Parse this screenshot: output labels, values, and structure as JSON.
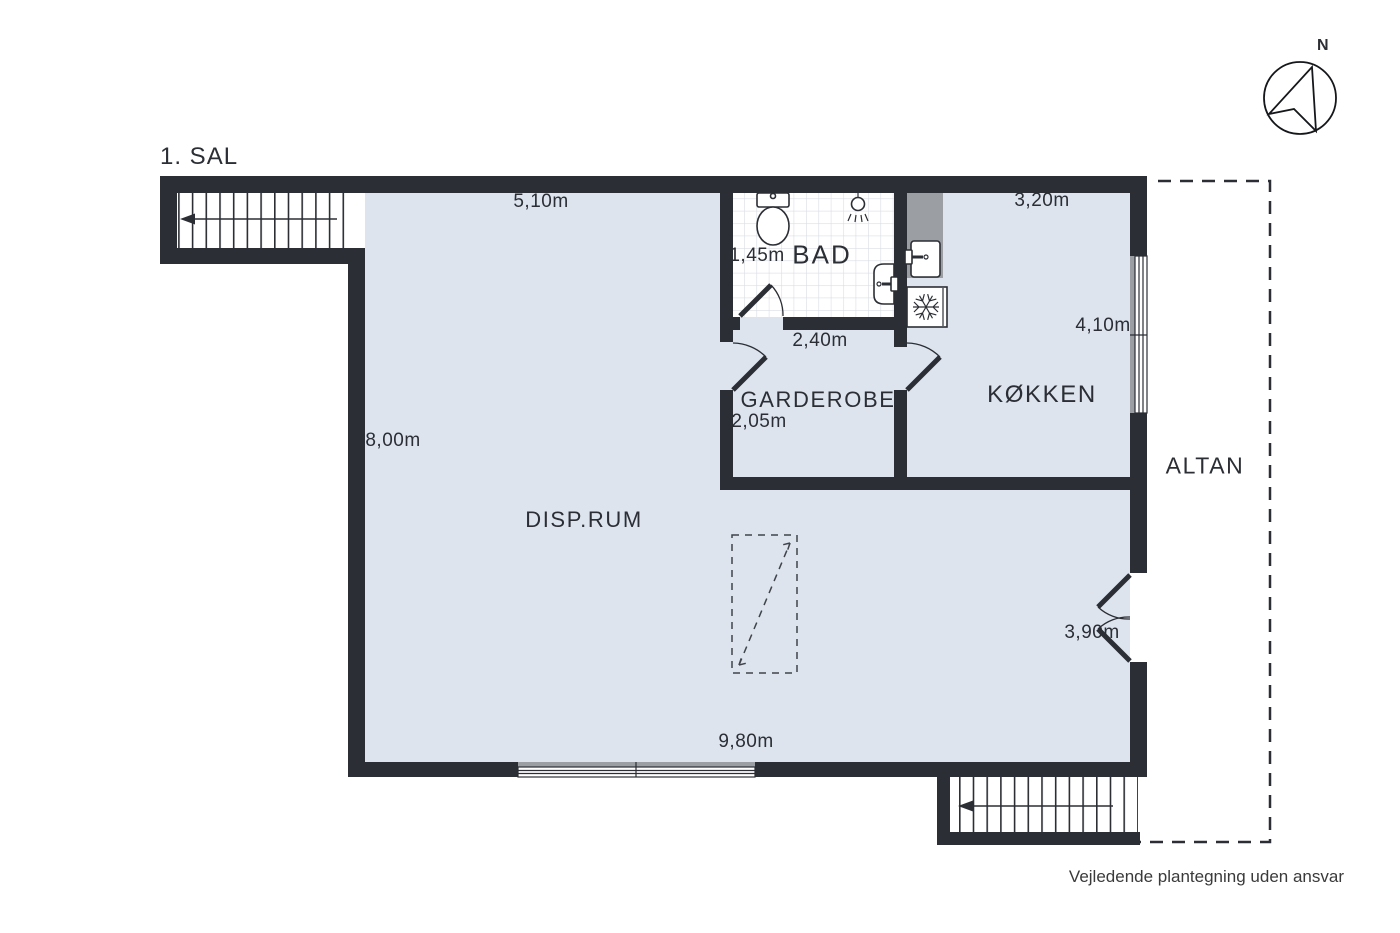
{
  "title": "1. SAL",
  "compass": {
    "north_label": "N"
  },
  "rooms": {
    "disprum": {
      "label": "DISP.RUM"
    },
    "garderobe": {
      "label": "GARDEROBE"
    },
    "bad": {
      "label": "BAD"
    },
    "kokken": {
      "label": "KØKKEN"
    },
    "altan": {
      "label": "ALTAN"
    }
  },
  "measurements": {
    "disprum_top": "5,10m",
    "disprum_left": "8,00m",
    "disprum_bottom": "9,80m",
    "bad_width": "1,45m",
    "garderobe_top": "2,40m",
    "garderobe_width": "2,05m",
    "kokken_top": "3,20m",
    "kokken_right": "4,10m",
    "balcony_door_width": "3,90m"
  },
  "footer": {
    "disclaimer": "Vejledende plantegning uden ansvar"
  },
  "colors": {
    "wall": "#2b2e34",
    "floor": "#dde4ee",
    "counter": "#9b9ea3",
    "tile_line": "#d9dde3",
    "outside": "#ffffff",
    "text": "#2b2e34"
  }
}
